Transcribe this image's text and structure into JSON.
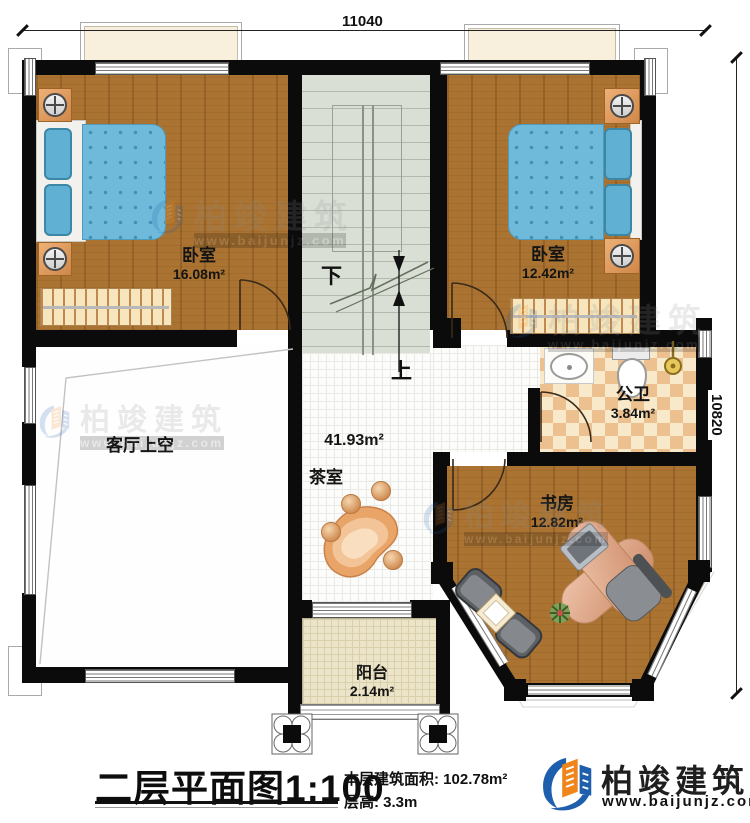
{
  "dimensions": {
    "top": "11040",
    "right": "10820"
  },
  "rooms": {
    "bedroom_left": {
      "name": "卧室",
      "area": "16.08m²"
    },
    "bedroom_right": {
      "name": "卧室",
      "area": "12.42m²"
    },
    "bathroom": {
      "name": "公卫",
      "area": "3.84m²"
    },
    "study": {
      "name": "书房",
      "area": "12.82m²"
    },
    "living_void": {
      "name": "客厅上空"
    },
    "tea_room": {
      "name": "茶室",
      "area": "41.93m²"
    },
    "balcony": {
      "name": "阳台",
      "area": "2.14m²"
    }
  },
  "stairs": {
    "down": "下",
    "up": "上"
  },
  "title": {
    "plan": "二层平面图",
    "scale": "1:100",
    "area_label": "本层建筑面积:",
    "area_value": "102.78m²",
    "floor_height_label": "层高:",
    "floor_height_value": "3.3m"
  },
  "brand": {
    "name": "柏竣建筑",
    "website": "www.baijunjz.com",
    "blue": "#1d5fad",
    "orange": "#f08519"
  },
  "watermark": {
    "name": "柏竣建筑",
    "website": "www.baijunjz.com"
  }
}
